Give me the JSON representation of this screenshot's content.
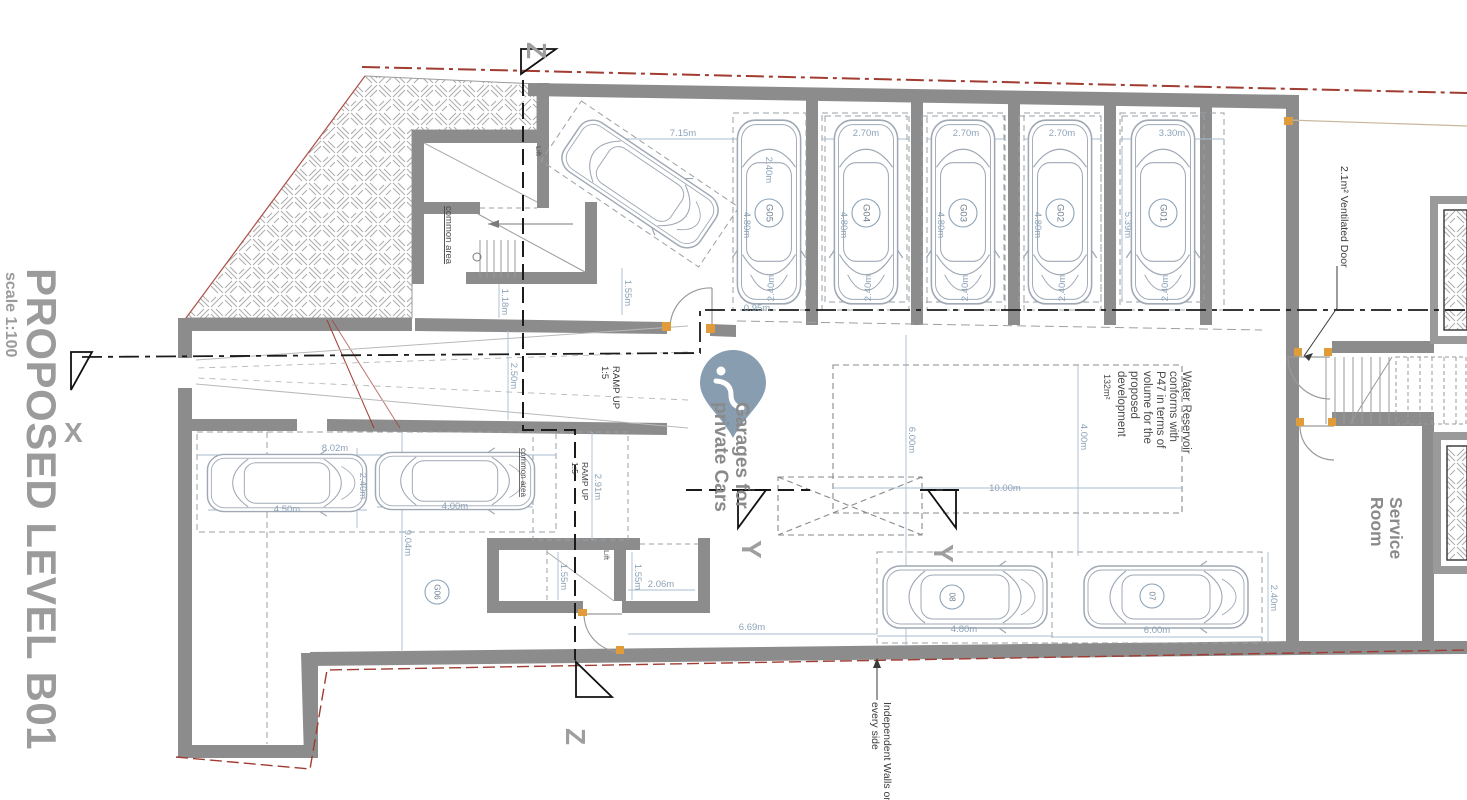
{
  "drawing": {
    "title": "PROPOSED LEVEL B01",
    "scale_note": "scale 1:100"
  },
  "colors": {
    "wall": "#8C8C8C",
    "dimension": "#8CA3B8",
    "dimension_line": "#AABDD0",
    "boundary_red": "#A03C32",
    "door_accent": "#E09B3A",
    "label_gray": "#8A8A8A",
    "text_dark": "#3F3F3F",
    "watermark": "#7E95AA",
    "car_outline": "#9FA8B4",
    "section_line": "#1B1B1B"
  },
  "section_markers": [
    {
      "letter": "Z",
      "x": 527,
      "y": 18,
      "rot": 90
    },
    {
      "letter": "Z",
      "x": 566,
      "y": 704,
      "rot": 90
    },
    {
      "letter": "X",
      "x": 64,
      "y": 418,
      "rot": 0
    },
    {
      "letter": "Y",
      "x": 742,
      "y": 516,
      "rot": 90
    },
    {
      "letter": "Y",
      "x": 934,
      "y": 520,
      "rot": 90
    }
  ],
  "labels": [
    {
      "name": "lift-label-upper",
      "lines": [
        "Lift"
      ],
      "x": 536,
      "y": 146,
      "rot": 90,
      "size": 7.5,
      "color": "#555555"
    },
    {
      "name": "lift-label-lower",
      "lines": [
        "Lift"
      ],
      "x": 604,
      "y": 550,
      "rot": 90,
      "size": 7.5,
      "color": "#555555"
    },
    {
      "name": "common-area-upper",
      "lines": [
        "common area"
      ],
      "x": 446,
      "y": 206,
      "rot": 90,
      "size": 9.5,
      "color": "#4A4A4A",
      "underline": true
    },
    {
      "name": "common-area-lower",
      "lines": [
        "common area"
      ],
      "x": 521,
      "y": 448,
      "rot": 90,
      "size": 8,
      "color": "#4A4A4A",
      "underline": true
    },
    {
      "name": "ramp-up-label-1",
      "lines": [
        "RAMP UP",
        "1:5"
      ],
      "x": 613,
      "y": 366,
      "rot": 90,
      "size": 9.5,
      "color": "#3C3C3C",
      "lh": 11
    },
    {
      "name": "ramp-up-label-2",
      "lines": [
        "RAMP UP",
        "1:5"
      ],
      "x": 582,
      "y": 462,
      "rot": 90,
      "size": 8.5,
      "color": "#3C3C3C",
      "lh": 10
    },
    {
      "name": "garages-private-cars",
      "lines": [
        "Garages for",
        "private Cars"
      ],
      "x": 736,
      "y": 402,
      "rot": 90,
      "size": 19,
      "weight": "bold",
      "color": "#8A8A8A",
      "lh": 21
    },
    {
      "name": "water-reservoir-note",
      "lines": [
        "Water Reservoir",
        "conforms with",
        "P47 in terms of",
        "volume for the",
        "proposed",
        "development"
      ],
      "x": 1183,
      "y": 371,
      "rot": 90,
      "size": 11.5,
      "color": "#4A4A4A",
      "lh": 13
    },
    {
      "name": "water-reservoir-area",
      "lines": [
        "132m²"
      ],
      "x": 1104,
      "y": 374,
      "rot": 90,
      "size": 9,
      "color": "#4A4A4A"
    },
    {
      "name": "service-room-label",
      "lines": [
        "Service",
        "Room"
      ],
      "x": 1390,
      "y": 497,
      "rot": 90,
      "size": 17.5,
      "weight": "bold",
      "color": "#8A8A8A",
      "lh": 19
    },
    {
      "name": "ventilated-door-note",
      "lines": [
        "2.1m² Ventilated Door"
      ],
      "x": 1341,
      "y": 166,
      "rot": 90,
      "size": 10.5,
      "color": "#3A3A3A"
    },
    {
      "name": "independent-walls-note",
      "lines": [
        "Independent Walls on",
        "every side"
      ],
      "x": 884,
      "y": 702,
      "rot": 90,
      "size": 10.5,
      "color": "#3A3A3A",
      "lh": 12
    }
  ],
  "dimensions": [
    {
      "text": "7.15m",
      "x": 683,
      "y": 136,
      "rot": 0
    },
    {
      "text": "2.40m",
      "x": 766,
      "y": 170,
      "rot": 90
    },
    {
      "text": "2.70m",
      "x": 866,
      "y": 136,
      "rot": 0
    },
    {
      "text": "2.70m",
      "x": 966,
      "y": 136,
      "rot": 0
    },
    {
      "text": "2.70m",
      "x": 1062,
      "y": 136,
      "rot": 0
    },
    {
      "text": "3.30m",
      "x": 1172,
      "y": 136,
      "rot": 0
    },
    {
      "text": "4.80m",
      "x": 744,
      "y": 225,
      "rot": 90
    },
    {
      "text": "4.80m",
      "x": 841,
      "y": 225,
      "rot": 90
    },
    {
      "text": "4.80m",
      "x": 938,
      "y": 225,
      "rot": 90
    },
    {
      "text": "4.80m",
      "x": 1035,
      "y": 225,
      "rot": 90
    },
    {
      "text": "5.39m",
      "x": 1125,
      "y": 225,
      "rot": 90
    },
    {
      "text": "2.40m",
      "x": 774,
      "y": 288,
      "rot": -90
    },
    {
      "text": "2.40m",
      "x": 871,
      "y": 288,
      "rot": -90
    },
    {
      "text": "2.40m",
      "x": 968,
      "y": 288,
      "rot": -90
    },
    {
      "text": "2.40m",
      "x": 1065,
      "y": 288,
      "rot": -90
    },
    {
      "text": "2.40m",
      "x": 1168,
      "y": 288,
      "rot": -90
    },
    {
      "text": "0.95m",
      "x": 757,
      "y": 311,
      "rot": 0
    },
    {
      "text": "1.55m",
      "x": 625,
      "y": 293,
      "rot": 90
    },
    {
      "text": "1.18m",
      "x": 502,
      "y": 302,
      "rot": 90
    },
    {
      "text": "2.50m",
      "x": 511,
      "y": 376,
      "rot": 90
    },
    {
      "text": "2.91m",
      "x": 595,
      "y": 487,
      "rot": 90
    },
    {
      "text": "1.55m",
      "x": 561,
      "y": 577,
      "rot": 90
    },
    {
      "text": "1.55m",
      "x": 635,
      "y": 577,
      "rot": 90
    },
    {
      "text": "2.06m",
      "x": 661,
      "y": 587,
      "rot": 0
    },
    {
      "text": "6.69m",
      "x": 752,
      "y": 630,
      "rot": 0
    },
    {
      "text": "4.80m",
      "x": 964,
      "y": 632,
      "rot": 0
    },
    {
      "text": "6.00m",
      "x": 1157,
      "y": 633,
      "rot": 0
    },
    {
      "text": "2.40m",
      "x": 1271,
      "y": 598,
      "rot": 90
    },
    {
      "text": "8.02m",
      "x": 335,
      "y": 451,
      "rot": 0
    },
    {
      "text": "2.40m",
      "x": 360,
      "y": 486,
      "rot": 90
    },
    {
      "text": "4.50m",
      "x": 287,
      "y": 512,
      "rot": 0
    },
    {
      "text": "4.00m",
      "x": 455,
      "y": 509,
      "rot": 0
    },
    {
      "text": "9.04m",
      "x": 405,
      "y": 543,
      "rot": 90
    },
    {
      "text": "6.00m",
      "x": 909,
      "y": 440,
      "rot": 90
    },
    {
      "text": "4.00m",
      "x": 1081,
      "y": 437,
      "rot": 90
    },
    {
      "text": "10.00m",
      "x": 1005,
      "y": 491,
      "rot": 0
    }
  ],
  "garage_labels": [
    {
      "text": "G05",
      "x": 769,
      "y": 213,
      "r": 14
    },
    {
      "text": "G04",
      "x": 866,
      "y": 213,
      "r": 14
    },
    {
      "text": "G03",
      "x": 963,
      "y": 213,
      "r": 14
    },
    {
      "text": "G02",
      "x": 1060,
      "y": 213,
      "r": 14
    },
    {
      "text": "G01",
      "x": 1163,
      "y": 213,
      "r": 14
    },
    {
      "text": "G06",
      "x": 437,
      "y": 592,
      "r": 12
    },
    {
      "text": "08",
      "x": 952,
      "y": 597,
      "r": 12
    },
    {
      "text": "07",
      "x": 1152,
      "y": 596,
      "r": 12
    }
  ],
  "cars": [
    {
      "x": 769,
      "y": 212,
      "rot": 90,
      "sx": 1.12,
      "sy": 1.02
    },
    {
      "x": 866,
      "y": 212,
      "rot": 90,
      "sx": 1.12,
      "sy": 1.02
    },
    {
      "x": 963,
      "y": 212,
      "rot": 90,
      "sx": 1.12,
      "sy": 1.02
    },
    {
      "x": 1060,
      "y": 212,
      "rot": 90,
      "sx": 1.12,
      "sy": 1.02
    },
    {
      "x": 1163,
      "y": 212,
      "rot": 90,
      "sx": 1.12,
      "sy": 1.02
    },
    {
      "x": 640,
      "y": 184,
      "rot": 34,
      "sx": 1.0,
      "sy": 0.95
    },
    {
      "x": 287,
      "y": 483,
      "rot": 0,
      "sx": 0.97,
      "sy": 0.92
    },
    {
      "x": 455,
      "y": 481,
      "rot": 0,
      "sx": 0.97,
      "sy": 0.92
    },
    {
      "x": 965,
      "y": 597,
      "rot": 0,
      "sx": 1.0,
      "sy": 1.0
    },
    {
      "x": 1166,
      "y": 597,
      "rot": 0,
      "sx": 1.0,
      "sy": 1.0
    }
  ],
  "watermark": {
    "type": "location-pin",
    "color": "#7E95AA"
  }
}
